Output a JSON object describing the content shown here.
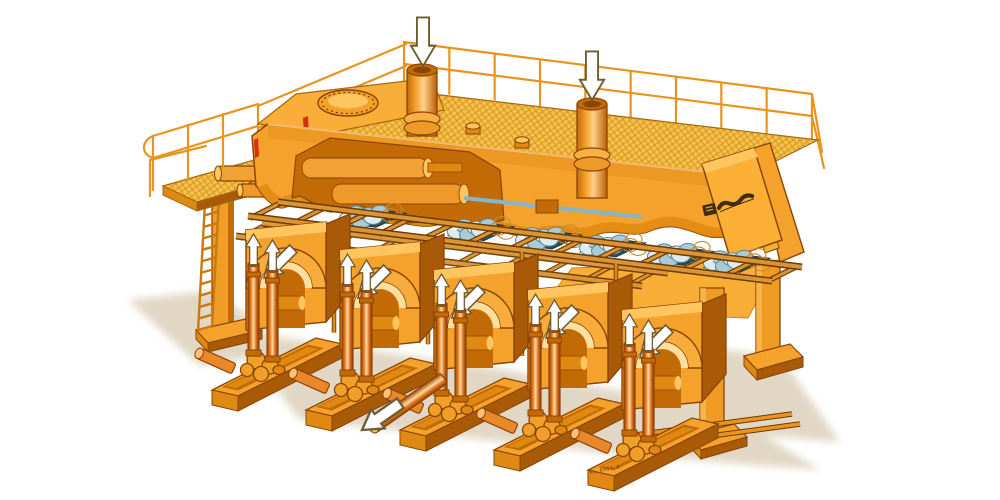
{
  "meta": {
    "type": "technical-illustration",
    "subject": "Isometric cutaway illustration of a multi-strand withdrawal / straightening machine with top service platform",
    "background": "#ffffff"
  },
  "palette": {
    "orangeMain": "#F4A22B",
    "orangeLight": "#FFC55F",
    "orangeLighter": "#FFDF9F",
    "orangeDark": "#E08912",
    "orangeDeep": "#C26A06",
    "orangeShade": "#A85A06",
    "outline": "#8A4506",
    "deepOutline": "#6E3A04",
    "copperDk": "#8F4406",
    "mesh": "#F6C04A",
    "meshLine": "#C68A12",
    "lid": "#F9AE39",
    "rollerPale": "#DCEBEF",
    "rollerMid": "#A8CBD6",
    "rollerDark": "#5E8490",
    "rollerGap": "#2E4C59",
    "redAccent": "#D43110",
    "shadow": "#DED3BE",
    "steel": "#85B5C6",
    "arrowFill": "#FFFFFF",
    "arrowOutline": "#6F5C31",
    "logoDark": "#3E2C10",
    "railing": "#E8941F"
  },
  "machine": {
    "strand_modules": 5,
    "roller_clusters": 6,
    "lift_rods_per_module": 2,
    "standpipes": 2,
    "manhole_covers": 2,
    "support_legs": 2,
    "guard_railing": true,
    "access_ladder": true,
    "drawing_number": "KL 0903 A",
    "brand_logo": {
      "present": true,
      "text_legible": false
    }
  },
  "flow_arrows": [
    {
      "name": "feed-arrow-left",
      "direction": "down",
      "count": 1,
      "style": "filled-white"
    },
    {
      "name": "feed-arrow-right",
      "direction": "down",
      "count": 1,
      "style": "filled-white"
    },
    {
      "name": "module-face-arrows",
      "direction": "down-left",
      "count": 5,
      "style": "filled-white"
    },
    {
      "name": "lift-rod-arrows",
      "direction": "up",
      "count": 10,
      "style": "filled-white"
    },
    {
      "name": "output-shaft-arrow",
      "direction": "down-left",
      "count": 1,
      "style": "outline-white"
    }
  ]
}
